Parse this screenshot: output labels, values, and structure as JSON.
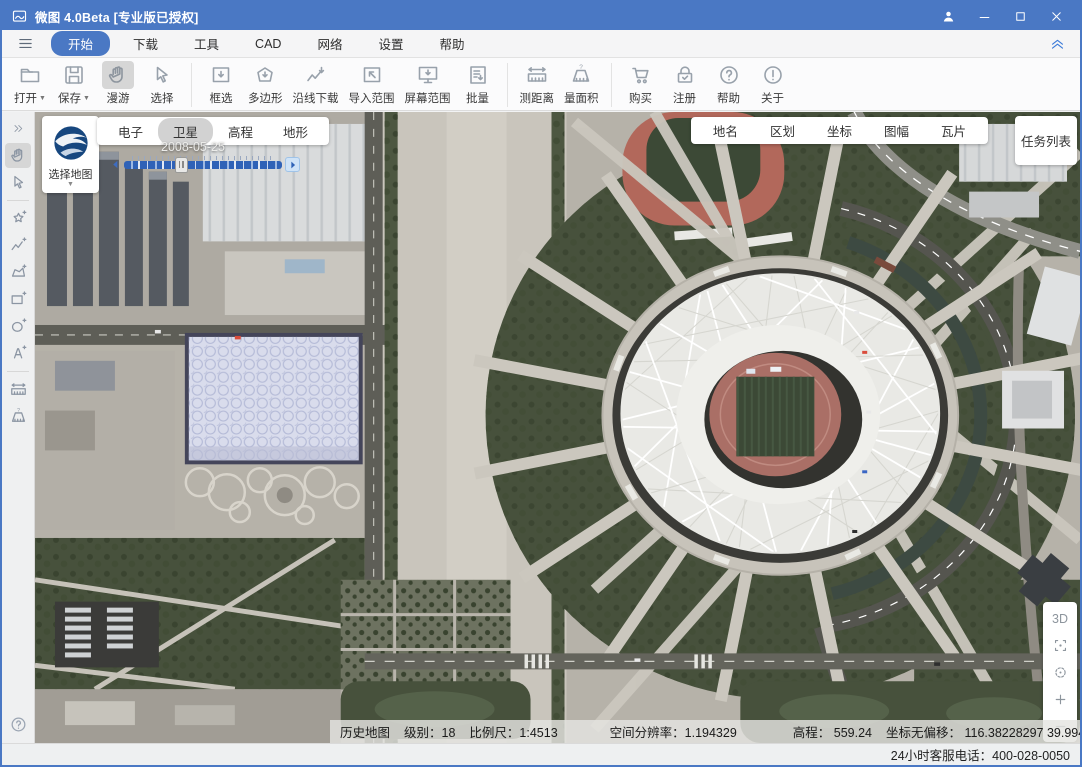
{
  "window": {
    "title": "微图 4.0Beta [专业版已授权]",
    "app_icon": "app-logo-icon",
    "controls": [
      {
        "icon": "user-icon"
      },
      {
        "icon": "minimize-icon"
      },
      {
        "icon": "maximize-icon"
      },
      {
        "icon": "close-icon"
      }
    ]
  },
  "menu": {
    "hamburger_icon": "hamburger-icon",
    "items": [
      {
        "label": "开始",
        "active": true
      },
      {
        "label": "下载"
      },
      {
        "label": "工具"
      },
      {
        "label": "CAD"
      },
      {
        "label": "网络"
      },
      {
        "label": "设置"
      },
      {
        "label": "帮助"
      }
    ],
    "collapse_icon": "collapse-chevrons-icon"
  },
  "ribbon": {
    "buttons": [
      {
        "label": "打开",
        "icon": "folder-icon",
        "dropdown": true
      },
      {
        "label": "保存",
        "icon": "save-icon",
        "dropdown": true
      },
      {
        "label": "漫游",
        "icon": "pan-hand-icon",
        "active": true
      },
      {
        "label": "选择",
        "icon": "select-cursor-icon"
      },
      {
        "label": "框选",
        "icon": "rect-download-icon"
      },
      {
        "label": "多边形",
        "icon": "polygon-download-icon"
      },
      {
        "label": "沿线下载",
        "icon": "route-download-icon"
      },
      {
        "label": "导入范围",
        "icon": "import-range-icon"
      },
      {
        "label": "屏幕范围",
        "icon": "screen-range-icon"
      },
      {
        "label": "批量",
        "icon": "batch-icon"
      },
      {
        "label": "测距离",
        "icon": "measure-distance-icon"
      },
      {
        "label": "量面积",
        "icon": "measure-area-icon"
      },
      {
        "label": "购买",
        "icon": "cart-icon"
      },
      {
        "label": "注册",
        "icon": "register-lock-icon"
      },
      {
        "label": "帮助",
        "icon": "help-icon"
      },
      {
        "label": "关于",
        "icon": "about-icon"
      }
    ]
  },
  "sidebar": {
    "tools": [
      {
        "icon": "expand-right-icon"
      },
      {
        "icon": "pan-hand-icon",
        "active": true
      },
      {
        "icon": "select-cursor-icon"
      },
      {
        "icon": "draw-freeform-icon"
      },
      {
        "icon": "draw-polyline-icon"
      },
      {
        "icon": "draw-polygon-icon"
      },
      {
        "icon": "draw-rect-icon"
      },
      {
        "icon": "draw-ellipse-icon"
      },
      {
        "icon": "draw-text-icon"
      },
      {
        "icon": "measure-distance-icon"
      },
      {
        "icon": "measure-area-icon"
      }
    ],
    "help_icon": "help-icon"
  },
  "map_overlay": {
    "map_picker": {
      "label": "选择地图",
      "logo_icon": "earth-logo-icon",
      "caret_icon": "dropdown-caret-icon"
    },
    "layer_tabs": [
      {
        "label": "电子"
      },
      {
        "label": "卫星",
        "active": true
      },
      {
        "label": "高程"
      },
      {
        "label": "地形"
      }
    ],
    "timeline": {
      "date": "2008-05-25",
      "prev_icon": "play-prev-icon",
      "next_icon": "play-next-icon"
    },
    "info_buttons": [
      {
        "label": "地名"
      },
      {
        "label": "区划"
      },
      {
        "label": "坐标"
      },
      {
        "label": "图幅"
      },
      {
        "label": "瓦片"
      }
    ],
    "task_list_label": "任务列表",
    "zoom_controls": [
      {
        "label": "3D"
      },
      {
        "icon": "fullscreen-icon"
      },
      {
        "icon": "locate-icon"
      },
      {
        "icon": "zoom-in-icon"
      },
      {
        "icon": "zoom-out-icon"
      }
    ]
  },
  "status_bar": {
    "items": [
      "历史地图",
      "级别：18",
      "比例尺：1:4513",
      "空间分辨率：1.194329",
      "高程： 559.24",
      "坐标无偏移： 116.38228297  39.9943220"
    ]
  },
  "footer": {
    "phone": "24小时客服电话：400-028-0050"
  },
  "colors": {
    "accent": "#4a78c4",
    "titlebar": "#4a78c4",
    "toolbar_icon": "#98a1ab",
    "active_tool_bg": "#d6d6d6",
    "timeline_blue": "#2f62b7"
  }
}
